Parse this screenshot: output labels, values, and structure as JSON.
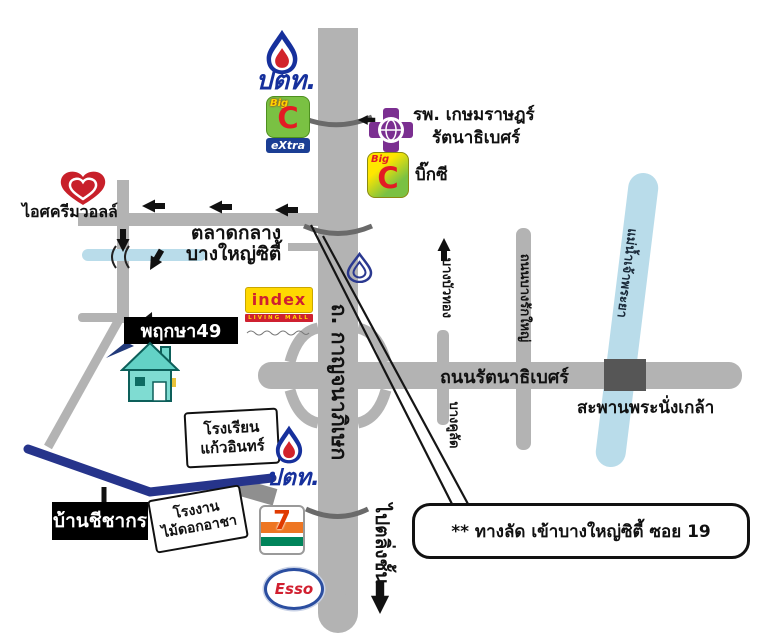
{
  "colors": {
    "road": "#b3b3b3",
    "water": "#b9dcea",
    "route_blue": "#26348b",
    "dark_bridge": "#565656",
    "ptt_blue": "#16309c",
    "ptt_red": "#d2232a",
    "bigc_green": "#7ac143",
    "bigc_red": "#e31b23",
    "extra_strip_blue": "#1b3e94",
    "hospital_purple": "#7b2f91",
    "index_yellow": "#ffd800",
    "index_red": "#cf2030",
    "walls_red": "#c8202a",
    "esso_red": "#d11f2f",
    "esso_blue": "#2b4ea0",
    "seven_orange": "#ee7623",
    "seven_green": "#00845a",
    "house_teal": "#6fd6cb"
  },
  "stations": {
    "ptt_top_label": "ปตท.",
    "ptt_south_label": "ปตท.",
    "esso_label": "Esso",
    "seven_label": "7"
  },
  "retail": {
    "bigc_extra": {
      "big": "Big",
      "c": "C",
      "strip": "eXtra"
    },
    "bigc": {
      "big": "Big",
      "c": "C",
      "name": "บิ๊กซี"
    },
    "index": {
      "name": "index",
      "strip": "LIVING MALL"
    },
    "walls": "ไอศครีมวอลล์",
    "market_line1": "ตลาดกลาง",
    "market_line2": "บางใหญ่ซิตี้"
  },
  "places": {
    "hospital_line1": "รพ. เกษมราษฎร์",
    "hospital_line2": "รัตนาธิเบศร์",
    "pruksa": "พฤกษา49",
    "school_line1": "โรงเรียน",
    "school_line2": "แก้วอินทร์",
    "baan": "บ้านชีชากร",
    "factory_line1": "โรงงาน",
    "factory_line2": "ไม้ดอกอาชา"
  },
  "roads": {
    "kanchanaphisek": "ถ. กาญจนาภิเษก",
    "rattanathibet": "ถนนรัตนาธิเบศร์",
    "bang_rak_yai": "ถนนบางรักใหญ่",
    "bang_bua_thong": "บางบัวทอง",
    "bang_khu_lad": "บางคูลัด",
    "to_taling_chan": "ไปตลิ่งชั้น"
  },
  "water": {
    "river": "แม่น้ำเจ้าพระยา",
    "bridge": "สะพานพระนั่งเกล้า"
  },
  "callout": {
    "text": "** ทางลัด เข้าบางใหญ่ซิตี้ ซอย 19"
  }
}
